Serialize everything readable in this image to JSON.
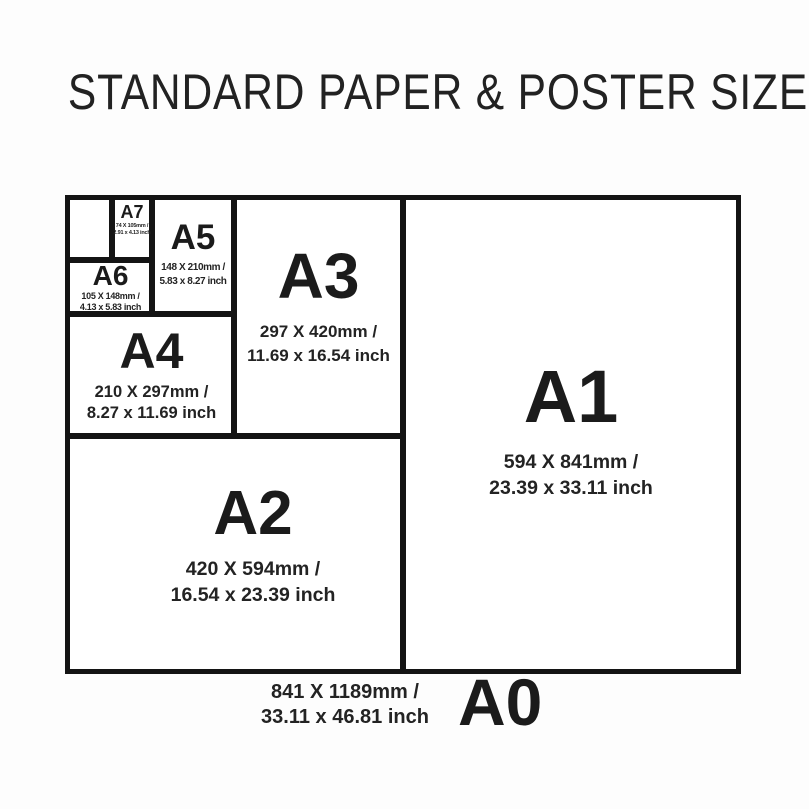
{
  "title": "STANDARD PAPER & POSTER SIZES",
  "colors": {
    "ink": "#1d1d1d",
    "line": "#141414",
    "background": "#ffffff"
  },
  "sizes": {
    "a7": {
      "label": "A7",
      "mm": "74 X 105mm /",
      "inch": "2.91 x 4.13 inch"
    },
    "a6": {
      "label": "A6",
      "mm": "105 X 148mm /",
      "inch": "4.13 x 5.83 inch"
    },
    "a5": {
      "label": "A5",
      "mm": "148 X 210mm /",
      "inch": "5.83 x 8.27 inch"
    },
    "a4": {
      "label": "A4",
      "mm": "210 X 297mm /",
      "inch": "8.27 x 11.69 inch"
    },
    "a3": {
      "label": "A3",
      "mm": "297 X 420mm /",
      "inch": "11.69 x 16.54 inch"
    },
    "a2": {
      "label": "A2",
      "mm": "420 X 594mm /",
      "inch": "16.54 x 23.39 inch"
    },
    "a1": {
      "label": "A1",
      "mm": "594 X 841mm /",
      "inch": "23.39 x 33.11 inch"
    },
    "a0": {
      "label": "A0",
      "mm": "841 X 1189mm /",
      "inch": "33.11 x 46.81 inch"
    }
  }
}
